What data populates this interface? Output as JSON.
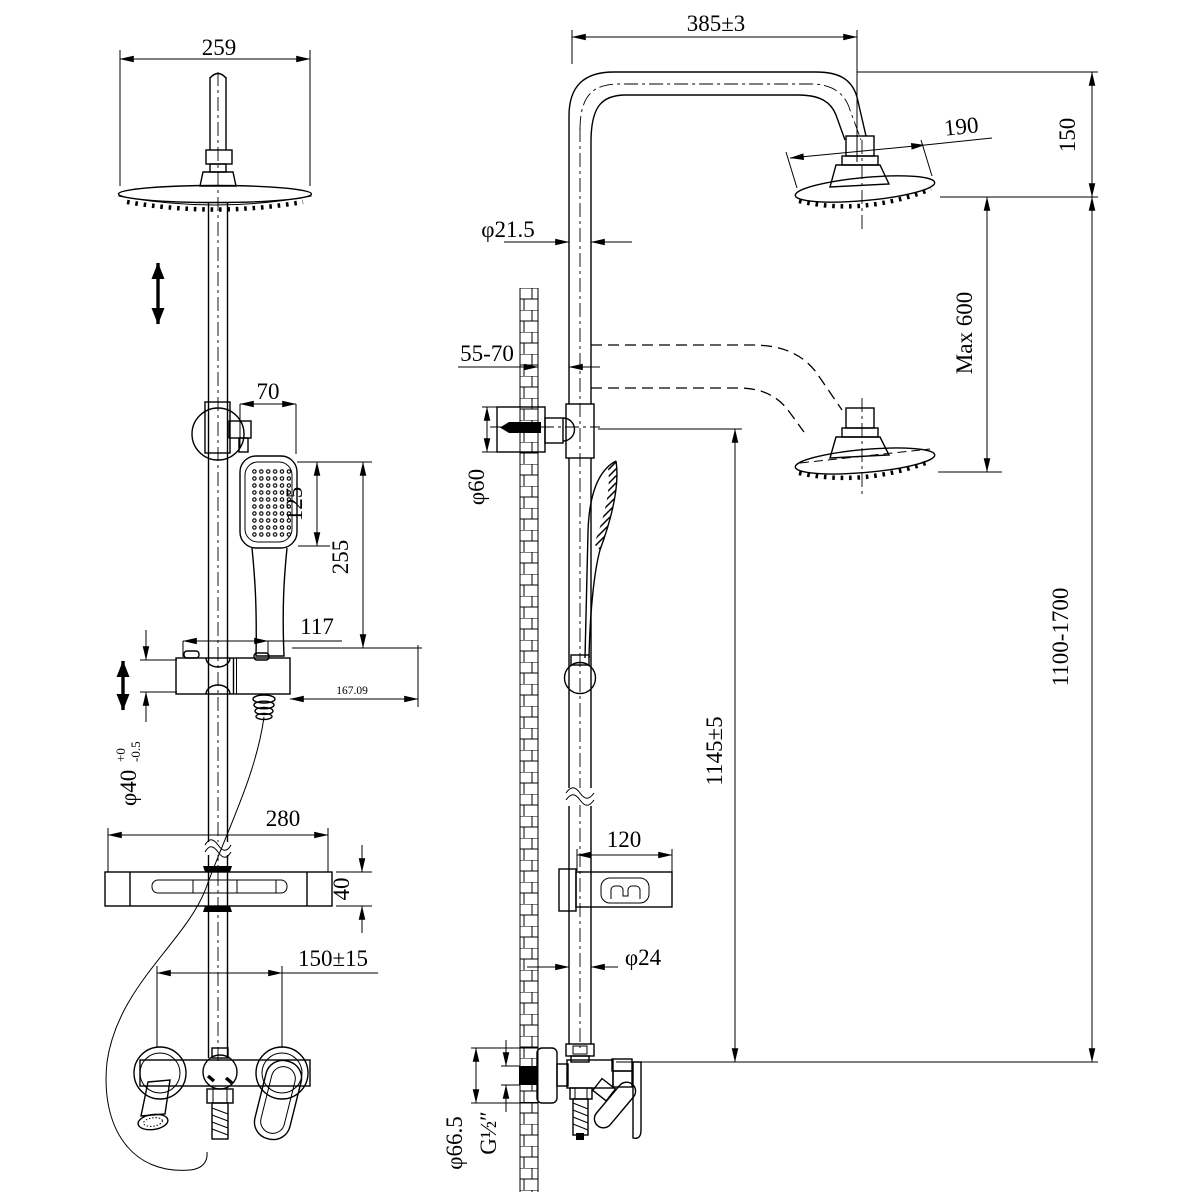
{
  "colors": {
    "ink": "#000000",
    "paper": "#ffffff"
  },
  "drawing": {
    "front_view": {
      "head_width": "259",
      "hand_shower_width": "70",
      "hand_shower_face_height": "125",
      "hand_shower_length": "255",
      "slider_width": "117",
      "slider_offset": "167.09",
      "pole_diameter": "φ40",
      "pole_tol_upper": "+0",
      "pole_tol_lower": "-0.5",
      "shelf_width": "280",
      "shelf_thickness": "40",
      "inlet_spacing": "150±15"
    },
    "side_view": {
      "arm_reach": "385±3",
      "head_diameter": "190",
      "head_drop": "150",
      "max_lower_drop": "Max 600",
      "overall_height": "1100-1700",
      "upper_pipe_diameter": "φ21.5",
      "wall_clearance": "55-70",
      "flange_diameter": "φ60",
      "hand_shower_height": "1145±5",
      "shelf_depth": "120",
      "pipe_diameter": "φ24",
      "escutcheon_diameter": "φ66.5",
      "thread_size": "G½″"
    }
  }
}
